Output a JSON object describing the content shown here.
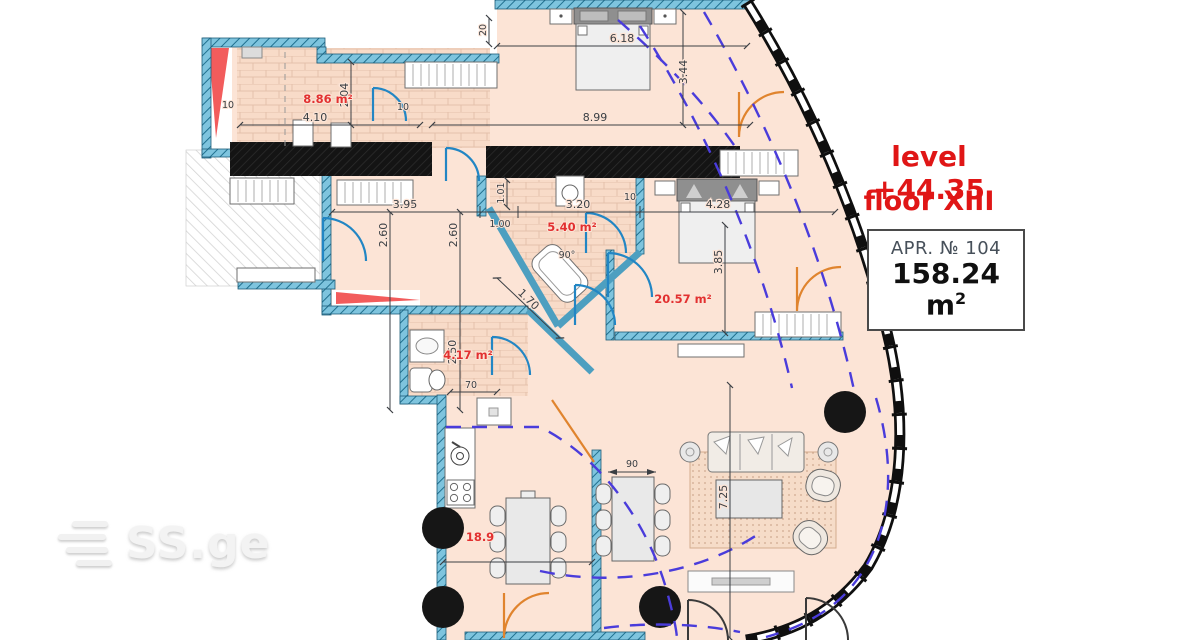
{
  "annotations": {
    "level": "level +44.35",
    "floor": "floor XIII",
    "apartment_number": "APR. № 104",
    "apartment_area": "158.24 m",
    "apartment_area_sup": "2"
  },
  "watermark": {
    "brand": "SS.ge"
  },
  "room_labels": {
    "laundry": "8.86 m²",
    "bathroom_main": "5.40 m²",
    "bedroom": "20.57 m²",
    "bathroom_small": "4.17 m²",
    "living": "18.9",
    "tub_angle": "90°"
  },
  "dimensions": {
    "bed1_width": "6.18",
    "bed1_depth": "3.44",
    "bed1_total": "8.99",
    "laundry_width": "4.10",
    "laundry_depth": "2.04",
    "wall_20": "20",
    "wall_10_a": "10",
    "wall_10_b": "10",
    "wall_10_c": "10",
    "hall_width": "3.95",
    "hall_depth_a": "2.60",
    "hall_depth_b": "2.60",
    "bath_niche_a": "1.01",
    "bath_niche_b": "1.00",
    "bath_width": "3.20",
    "bed2_width": "4.28",
    "bed2_depth": "3.85",
    "hall_diag": "1.70",
    "wc_depth": "2.50",
    "wc_width": "70",
    "table_width": "90",
    "living_depth": "7.25"
  },
  "colors": {
    "accent_red": "#e01616",
    "floor_peach": "#fce4d6",
    "wall_teal": "#7ec4de",
    "wall_black": "#161616",
    "dash_blue": "#4a3cdb",
    "door_blue": "#2286c4",
    "door_orange": "#e0842e"
  }
}
